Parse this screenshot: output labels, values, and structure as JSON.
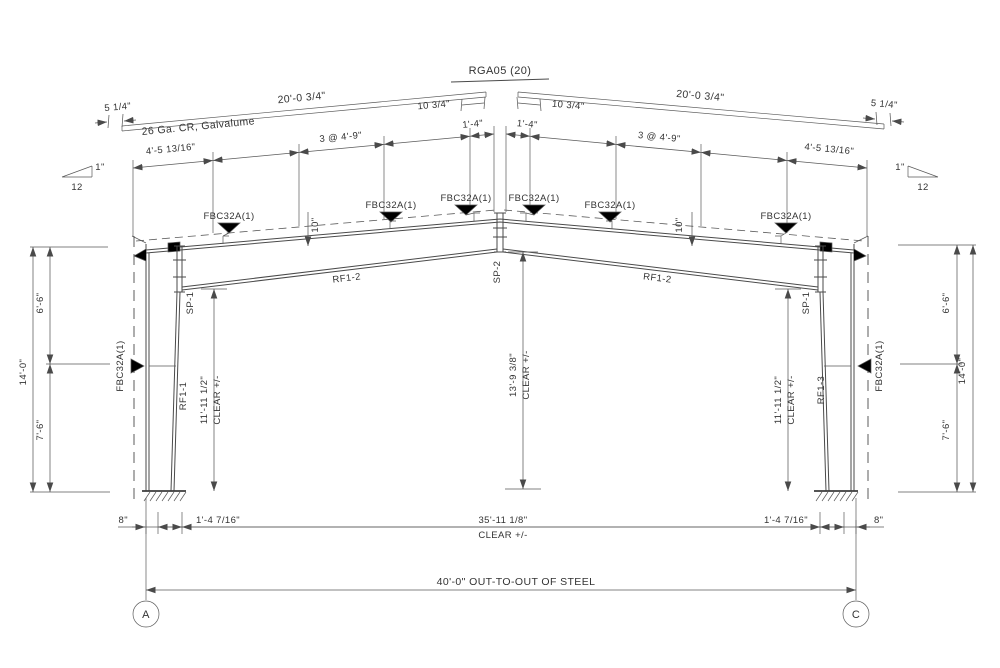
{
  "drawing": {
    "title": "RGA05 (20)",
    "roof_panel": {
      "material": "26 Ga. CR, Galvalume",
      "left_length": "20'-0 3/4\"",
      "right_length": "20'-0 3/4\"",
      "left_end": "5 1/4\"",
      "right_end": "5 1/4\"",
      "left_ridge": "10 3/4\"",
      "right_ridge": "10 3/4\""
    },
    "slope_symbol": {
      "rise": "1\"",
      "run": "12"
    },
    "purlin_spacing": {
      "left_end_bay": "4'-5 13/16\"",
      "left_bays": "3 @ 4'-9\"",
      "left_ridge_bay": "1'-4\"",
      "right_ridge_bay": "1'-4\"",
      "right_bays": "3 @ 4'-9\"",
      "right_end_bay": "4'-5 13/16\"",
      "left_offset": "10\"",
      "right_offset": "10\""
    },
    "flange_brace": "FBC32A(1)",
    "members": {
      "left_rafter": "RF1-2",
      "right_rafter": "RF1-2",
      "left_column": "RF1-1",
      "right_column": "RF1-3",
      "left_knee_splice": "SP-1",
      "right_knee_splice": "SP-1",
      "ridge_splice": "SP-2"
    },
    "heights": {
      "left_upper": "6'-6\"",
      "left_lower": "7'-6\"",
      "left_total": "14'-0\"",
      "right_upper": "6'-6\"",
      "right_lower": "7'-6\"",
      "right_total": "14'-0\"",
      "left_clear": "11'-11 1/2\"",
      "right_clear": "11'-11 1/2\"",
      "center_clear": "13'-9 3/8\"",
      "clear_tol": "CLEAR +/-"
    },
    "width_dims": {
      "left_eave_offset": "8\"",
      "left_inset": "1'-4 7/16\"",
      "clear_span": "35'-11 1/8\"",
      "clear_tol": "CLEAR +/-",
      "right_inset": "1'-4 7/16\"",
      "right_eave_offset": "8\"",
      "out_to_out": "40'-0\" OUT-TO-OUT OF STEEL"
    },
    "grid": {
      "left": "A",
      "right": "C"
    }
  }
}
